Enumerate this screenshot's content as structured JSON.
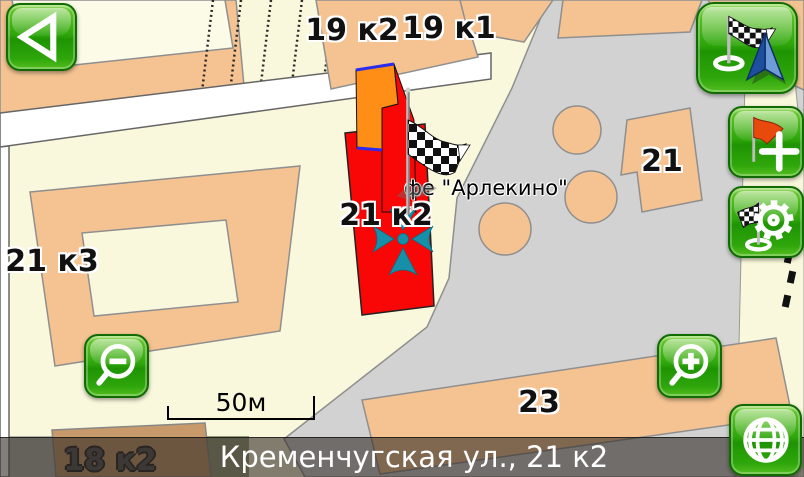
{
  "app": {
    "type": "gps-navigation-map-screen"
  },
  "map_labels": {
    "building_19k2": "19 к2",
    "building_19k1": "19 к1",
    "building_21": "21",
    "building_21k2": "21 к2",
    "building_21k3": "21 к3",
    "building_23": "23",
    "building_18k2": "18 к2",
    "poi_arlekino": "фе \"Арлекино\""
  },
  "scale_bar": {
    "label": "50м"
  },
  "status_bar": {
    "address": "Кременчугская ул., 21 к2"
  },
  "controls": {
    "back": {
      "icon": "back-arrow-icon"
    },
    "route_finish": {
      "icon": "checkered-flag-with-navigation-arrow-icon"
    },
    "add_waypoint": {
      "icon": "red-flag-plus-icon"
    },
    "route_options": {
      "icon": "checkered-flag-gear-icon"
    },
    "zoom_out": {
      "icon": "magnifier-minus-icon"
    },
    "zoom_in": {
      "icon": "magnifier-plus-icon"
    },
    "map_view": {
      "icon": "globe-icon"
    }
  },
  "markers": {
    "finish_flag": "checkered-finish-flag-marker",
    "position_cursor": "teal-gps-cursor"
  },
  "colors": {
    "background": "#FAF8DC",
    "building": "#F5C392",
    "plaza": "#D2D2D2",
    "highlight_building": "#F90606",
    "road": "#FFFFFF",
    "button_green": "#2EA60B",
    "cursor_teal": "#1690A8"
  }
}
